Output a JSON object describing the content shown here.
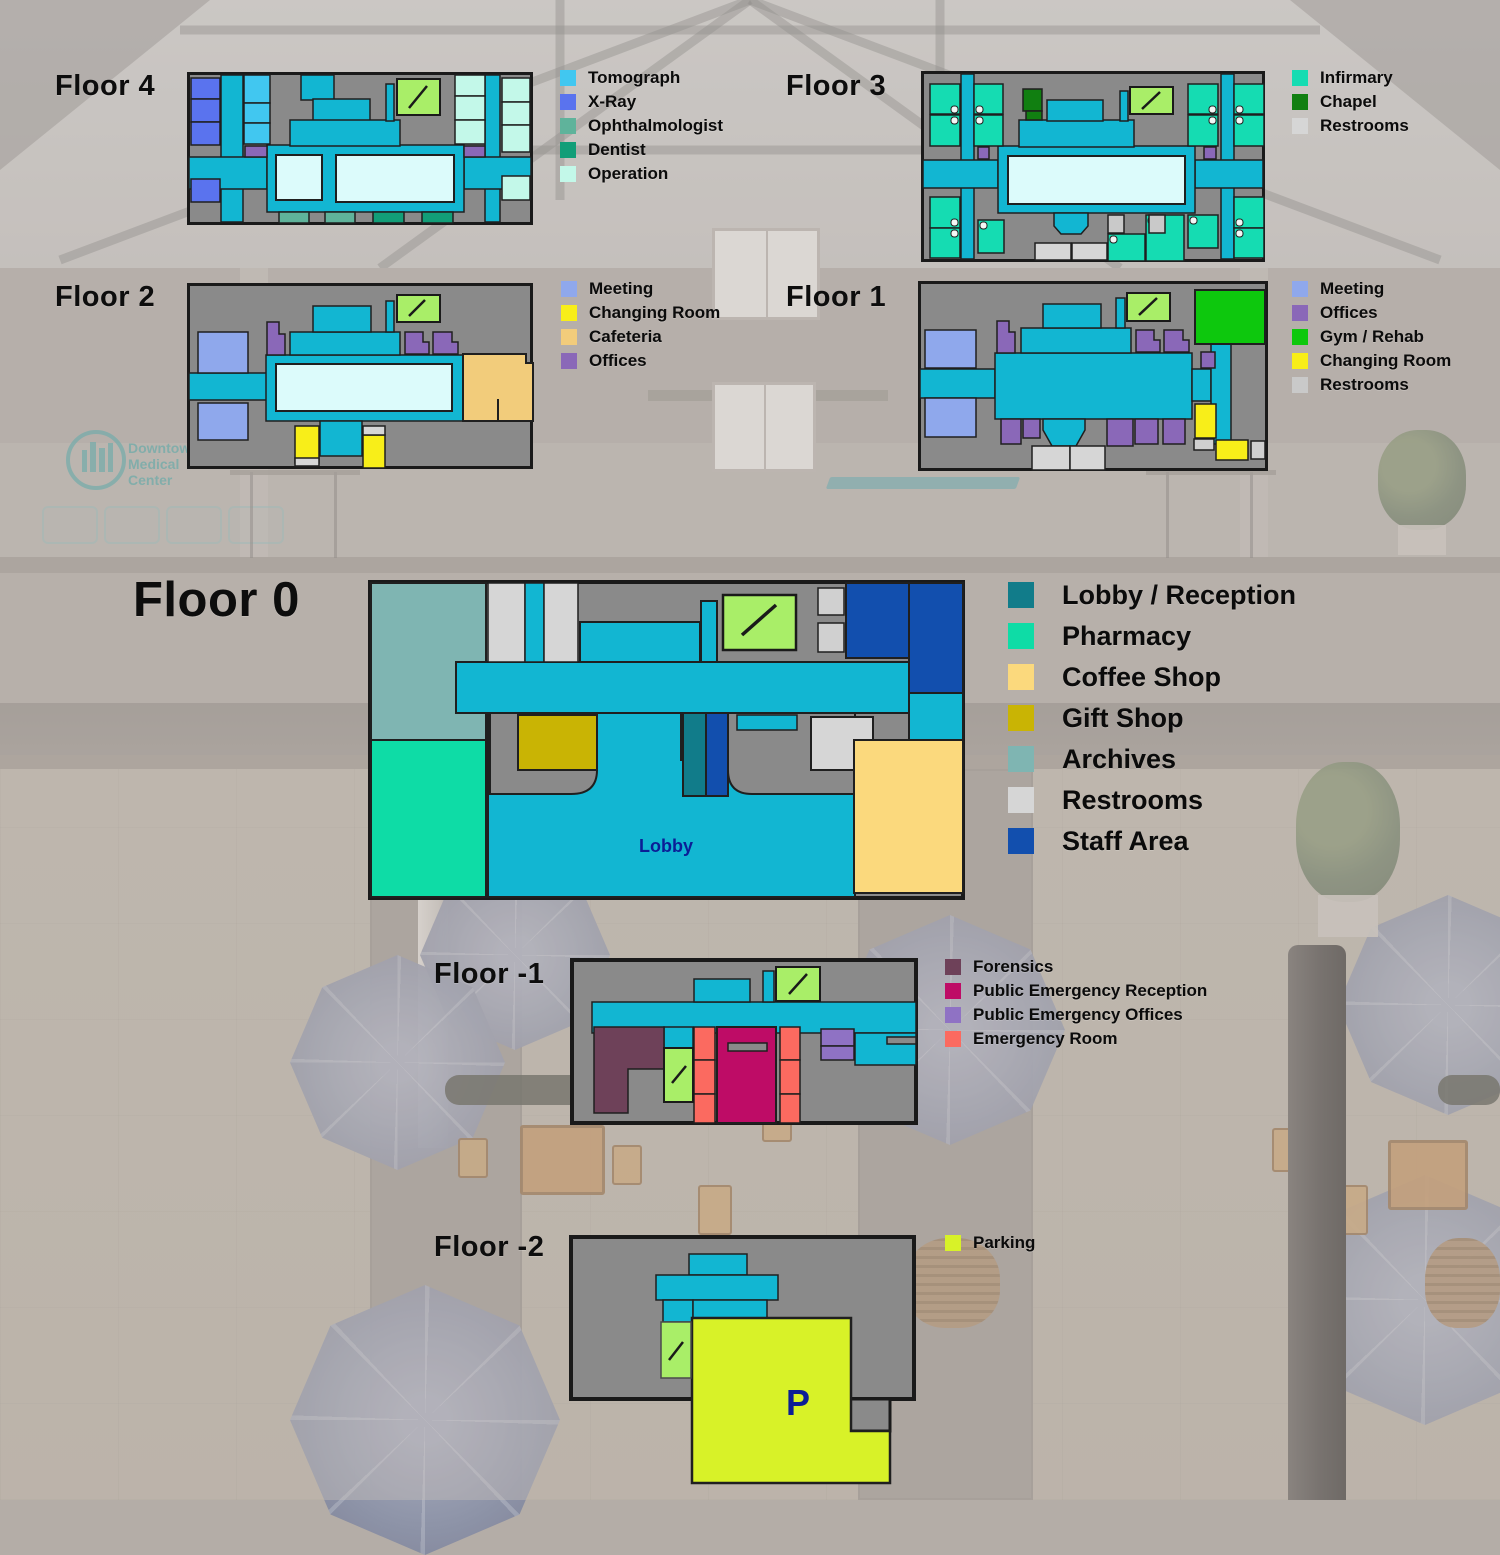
{
  "floors": [
    {
      "id": "floor-4",
      "label": "Floor 4",
      "legend": [
        {
          "label": "Tomograph",
          "color": "#41C7F0"
        },
        {
          "label": "X-Ray",
          "color": "#5A73EE"
        },
        {
          "label": "Ophthalmologist",
          "color": "#5FB39B"
        },
        {
          "label": "Dentist",
          "color": "#129E78"
        },
        {
          "label": "Operation",
          "color": "#C3F8E9"
        }
      ]
    },
    {
      "id": "floor-3",
      "label": "Floor 3",
      "legend": [
        {
          "label": "Infirmary",
          "color": "#15DCB2"
        },
        {
          "label": "Chapel",
          "color": "#117F11"
        },
        {
          "label": "Restrooms",
          "color": "#D6D6D6"
        }
      ]
    },
    {
      "id": "floor-2",
      "label": "Floor 2",
      "legend": [
        {
          "label": "Meeting",
          "color": "#8FA8EC"
        },
        {
          "label": "Changing Room",
          "color": "#F8EE19"
        },
        {
          "label": "Cafeteria",
          "color": "#F2CC7B"
        },
        {
          "label": "Offices",
          "color": "#8A68B8"
        }
      ]
    },
    {
      "id": "floor-1",
      "label": "Floor 1",
      "legend": [
        {
          "label": "Meeting",
          "color": "#8FA8EC"
        },
        {
          "label": "Offices",
          "color": "#8A68B8"
        },
        {
          "label": "Gym / Rehab",
          "color": "#0DC80D"
        },
        {
          "label": "Changing Room",
          "color": "#F8EE19"
        },
        {
          "label": "Restrooms",
          "color": "#C9C9C9"
        }
      ]
    },
    {
      "id": "floor-0",
      "label": "Floor 0",
      "room_label": "Lobby",
      "legend": [
        {
          "label": "Lobby / Reception",
          "color": "#117C8A"
        },
        {
          "label": "Pharmacy",
          "color": "#0EDCA6"
        },
        {
          "label": "Coffee Shop",
          "color": "#FBD97D"
        },
        {
          "label": "Gift Shop",
          "color": "#C9B404"
        },
        {
          "label": "Archives",
          "color": "#7FB5B2"
        },
        {
          "label": "Restrooms",
          "color": "#D6D6D6"
        },
        {
          "label": "Staff Area",
          "color": "#124FAE"
        }
      ]
    },
    {
      "id": "floor-minus-1",
      "label": "Floor -1",
      "legend": [
        {
          "label": "Forensics",
          "color": "#6E4159"
        },
        {
          "label": "Public Emergency Reception",
          "color": "#BE0C66"
        },
        {
          "label": "Public Emergency Offices",
          "color": "#8F72C4"
        },
        {
          "label": "Emergency Room",
          "color": "#FB6A60"
        }
      ]
    },
    {
      "id": "floor-minus-2",
      "label": "Floor -2",
      "room_label": "P",
      "legend": [
        {
          "label": "Parking",
          "color": "#D8F228"
        }
      ]
    }
  ],
  "map_colors": {
    "corridor": "#12B6D2",
    "map_background": "#8A8A8A",
    "room_floor_pale": "#DCFBFB",
    "elevator": "#A9EE68",
    "outline": "#1F1F1F",
    "map_text": "#0B1E96"
  },
  "background": {
    "logo_lines": [
      "Downtown",
      "Medical",
      "Center"
    ]
  }
}
